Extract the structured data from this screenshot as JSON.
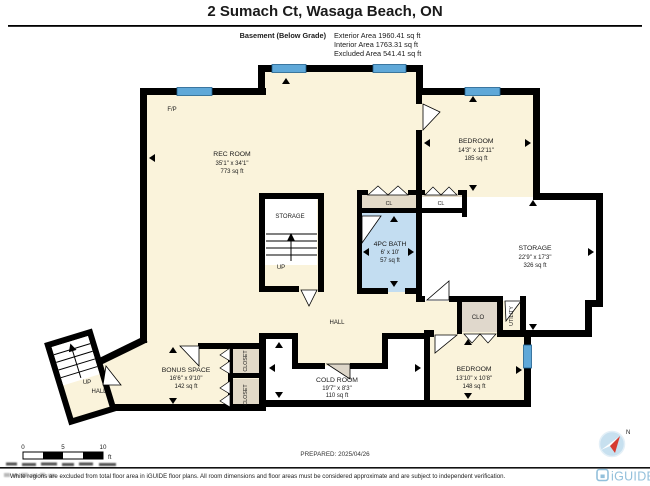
{
  "title": "2 Sumach Ct, Wasaga Beach, ON",
  "floor_info": {
    "floor_label": "Basement (Below Grade)",
    "exterior_area": "Exterior Area 1960.41 sq ft",
    "interior_area": "Interior Area 1763.31 sq ft",
    "excluded_area": "Excluded Area 541.41 sq ft"
  },
  "rooms": {
    "rec_room": {
      "name": "REC ROOM",
      "dims": "35'1\" x 34'1\"",
      "area": "773 sq ft"
    },
    "bedroom_upper": {
      "name": "BEDROOM",
      "dims": "14'3\" x 12'11\"",
      "area": "185 sq ft"
    },
    "bath": {
      "name": "4PC BATH",
      "dims": "6' x 10'",
      "area": "57 sq ft"
    },
    "storage_right": {
      "name": "STORAGE",
      "dims": "22'9\" x 17'3\"",
      "area": "326 sq ft"
    },
    "storage_center": {
      "name": "STORAGE"
    },
    "bedroom_lower": {
      "name": "BEDROOM",
      "dims": "13'10\" x 10'8\"",
      "area": "148 sq ft"
    },
    "cold_room": {
      "name": "COLD ROOM",
      "dims": "19'7\" x 8'3\"",
      "area": "110 sq ft"
    },
    "bonus_space": {
      "name": "BONUS SPACE",
      "dims": "16'6\" x 9'10\"",
      "area": "142 sq ft"
    },
    "hall": {
      "name": "HALL"
    },
    "hall_stair": {
      "name": "HALL"
    },
    "utility": {
      "name": "UTILITY"
    },
    "clo": {
      "name": "CLO"
    },
    "cl_left": {
      "name": "CL"
    },
    "cl_right": {
      "name": "CL"
    },
    "closet_upper": {
      "name": "CLOSET"
    },
    "closet_lower": {
      "name": "CLOSET"
    },
    "fireplace": {
      "label": "F/P"
    },
    "stairs_center": {
      "up_label": "UP"
    },
    "stairs_left": {
      "up_label": "UP"
    }
  },
  "scale_bar": {
    "start": "0",
    "mid": "5",
    "end": "10",
    "unit": "ft"
  },
  "prepared": "PREPARED: 2025/04/26",
  "compass": {
    "north_label": "N"
  },
  "footer": {
    "disclaimer": "White regions are excluded from total floor area in iGUIDE floor plans. All room dimensions and floor areas must be considered approximate and are subject to independent verification.",
    "brand": "iGUIDE"
  },
  "colors": {
    "wall": "#000000",
    "floor_beige": "#FAF3DB",
    "excluded_white": "#FFFFFF",
    "bath_blue": "#C3DDF1",
    "closet_tan": "#E3DAC8",
    "window_blue": "#5FA8D8",
    "brand_blue": "#93C0DB",
    "compass_red": "#D63B30"
  }
}
